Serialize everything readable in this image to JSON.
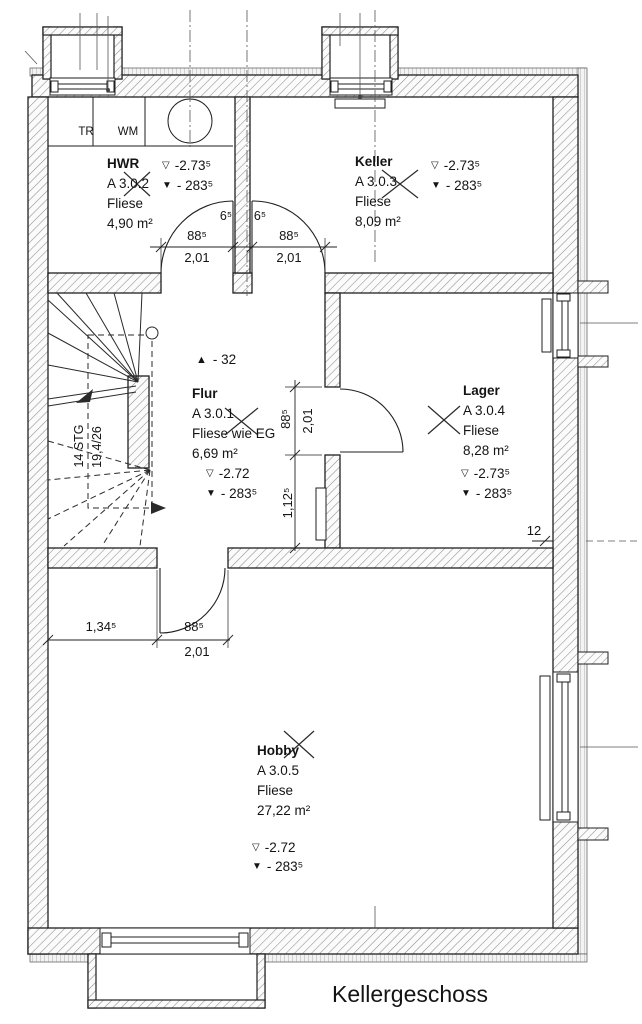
{
  "title": "Kellergeschoss",
  "symbols": {
    "ffb": "▽",
    "rfb": "▼",
    "step": "▲"
  },
  "rooms": [
    {
      "name": "Flur",
      "number": "A 3.0.1",
      "floor": "Fliese wie EG",
      "area": "6,69 m²",
      "ffb": "-2.72",
      "rfb": "- 283⁵"
    },
    {
      "name": "HWR",
      "number": "A 3.0.2",
      "floor": "Fliese",
      "area": "4,90 m²",
      "ffb": "-2.73⁵",
      "rfb": "- 283⁵"
    },
    {
      "name": "Keller",
      "number": "A 3.0.3",
      "floor": "Fliese",
      "area": "8,09 m²",
      "ffb": "-2.73⁵",
      "rfb": "- 283⁵"
    },
    {
      "name": "Lager",
      "number": "A 3.0.4",
      "floor": "Fliese",
      "area": "8,28 m²",
      "ffb": "-2.73⁵",
      "rfb": "- 283⁵"
    },
    {
      "name": "Hobby",
      "number": "A 3.0.5",
      "floor": "Fliese",
      "area": "27,22 m²",
      "ffb": "-2.72",
      "rfb": "- 283⁵"
    }
  ],
  "stair": {
    "steps": "14 STG",
    "ratio": "19,4/26"
  },
  "step_annotation": "- 32",
  "equipment": {
    "dryer": "TR",
    "washer": "WM"
  },
  "dimensions": {
    "door_hwr_width": "88⁵",
    "door_hwr_height": "2,01",
    "door_keller_width": "88⁵",
    "door_keller_height": "2,01",
    "jamb_left": "6⁵",
    "jamb_right": "6⁵",
    "door_lager_width": "88⁵",
    "door_lager_height": "2,01",
    "flur_segment": "1,12⁵",
    "hobby_wall_offset": "1,34⁵",
    "door_hobby_width": "88⁵",
    "door_hobby_height": "2,01",
    "wall_thickness": "12"
  }
}
